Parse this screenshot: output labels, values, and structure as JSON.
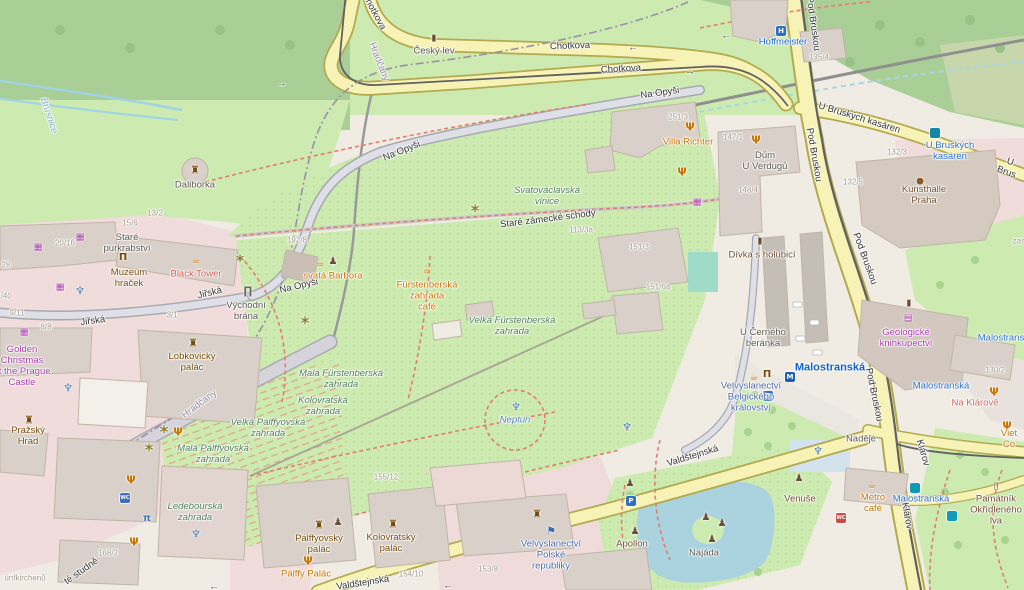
{
  "map_title": "OpenStreetMap — Prague Castle / Malostranská area",
  "colors": {
    "base": "#f0ece4",
    "forest": "#a9cf97",
    "grass": "#cdebb0",
    "scrub": "#c8d7ab",
    "attraction_pink": "#f0dcda",
    "building": "#d9d0c9",
    "road_yellow": "#f7f3b6",
    "road_gray": "#dfdfe8",
    "water": "#aad3df",
    "path_red": "#e07f70",
    "transit_blue": "#2a6fc9",
    "poi_orange": "#c77400",
    "shop_purple": "#ac39ac"
  },
  "labels": [
    {
      "n": "street-chotkova-1",
      "t": "Chotkova",
      "x": 570,
      "y": 47,
      "c": "road",
      "r": -2
    },
    {
      "n": "street-chotkova-2",
      "t": "Chotkova",
      "x": 621,
      "y": 70,
      "c": "road",
      "r": -3
    },
    {
      "n": "street-chotkova-3",
      "t": "Chotkova",
      "x": 373,
      "y": 12,
      "c": "road",
      "r": 62
    },
    {
      "n": "street-na-opysi-1",
      "t": "Na Opyši",
      "x": 660,
      "y": 94,
      "c": "road",
      "r": -8
    },
    {
      "n": "street-na-opysi-2",
      "t": "Na Opyši",
      "x": 402,
      "y": 152,
      "c": "road",
      "r": -22
    },
    {
      "n": "street-na-opysi-3",
      "t": "Na Opyši",
      "x": 299,
      "y": 287,
      "c": "road",
      "r": -13
    },
    {
      "n": "street-pod-bruskou-1",
      "t": "Pod Bruskou",
      "x": 812,
      "y": 24,
      "c": "road",
      "r": 82
    },
    {
      "n": "street-pod-bruskou-2",
      "t": "Pod Bruskou",
      "x": 813,
      "y": 155,
      "c": "road",
      "r": 80
    },
    {
      "n": "street-pod-bruskou-3",
      "t": "Pod Bruskou",
      "x": 864,
      "y": 259,
      "c": "road",
      "r": 70
    },
    {
      "n": "street-pod-bruskou-4",
      "t": "Pod Bruskou",
      "x": 873,
      "y": 395,
      "c": "road",
      "r": 78
    },
    {
      "n": "street-u-bruskych-kasaren",
      "t": "U Bruských kasáren",
      "x": 859,
      "y": 119,
      "c": "road",
      "r": 17
    },
    {
      "n": "street-u-bruskych-partial",
      "t": "U Brus",
      "x": 1008,
      "y": 168,
      "c": "road",
      "r": 20
    },
    {
      "n": "street-klarov-1",
      "t": "Klárov",
      "x": 922,
      "y": 453,
      "c": "road",
      "r": 74
    },
    {
      "n": "street-klarov-2",
      "t": "Klárov",
      "x": 906,
      "y": 516,
      "c": "road",
      "r": 80
    },
    {
      "n": "street-valdstejnska-1",
      "t": "Valdštejnská",
      "x": 693,
      "y": 457,
      "c": "road",
      "r": -17
    },
    {
      "n": "street-valdstejnska-2",
      "t": "Valdštejnská",
      "x": 363,
      "y": 584,
      "c": "road",
      "r": -9
    },
    {
      "n": "street-jirska-1",
      "t": "Jiřská",
      "x": 93,
      "y": 322,
      "c": "road",
      "r": -8
    },
    {
      "n": "street-jirska-2",
      "t": "Jiřská",
      "x": 210,
      "y": 294,
      "c": "road",
      "r": -14
    },
    {
      "n": "street-stare-zamecke-schody",
      "t": "Staré zámecké schody",
      "x": 548,
      "y": 220,
      "c": "road",
      "r": -7
    },
    {
      "n": "street-studne-partial",
      "t": "té studně",
      "x": 82,
      "y": 572,
      "c": "road",
      "r": -35
    },
    {
      "n": "stream-brusnice",
      "t": "Brusnice",
      "x": 48,
      "y": 116,
      "c": "stream",
      "r": 72
    },
    {
      "n": "boundary-hradcany-1",
      "t": "Hradčany",
      "x": 378,
      "y": 62,
      "c": "boundary",
      "r": 68
    },
    {
      "n": "boundary-hradcany-2",
      "t": "Hradčany",
      "x": 200,
      "y": 405,
      "c": "boundary",
      "r": -37
    },
    {
      "n": "poi-cesky-lev",
      "t": "Český lev",
      "x": 434,
      "y": 52,
      "c": "poi"
    },
    {
      "n": "poi-hoffmeister",
      "t": "Hoffmeister",
      "x": 783,
      "y": 43,
      "c": "hotel"
    },
    {
      "n": "poi-villa-richter",
      "t": "Villa Richter",
      "x": 688,
      "y": 143,
      "c": "food"
    },
    {
      "n": "poi-dum-u-verdugu",
      "t": "Dům\nU Verdugů",
      "x": 765,
      "y": 162,
      "c": "poi"
    },
    {
      "n": "transit-u-bruskych-kasaren",
      "t": "U Bruských\nkasáren",
      "x": 950,
      "y": 152,
      "c": "blue"
    },
    {
      "n": "poi-kunsthalle-praha",
      "t": "Kunsthalle\nPraha",
      "x": 924,
      "y": 196,
      "c": "brown2"
    },
    {
      "n": "poi-geologicke-knihkupectvi",
      "t": "Geologické\nknihkupectví",
      "x": 906,
      "y": 339,
      "c": "shop"
    },
    {
      "n": "station-malostranska",
      "t": "Malostranská",
      "x": 830,
      "y": 368,
      "c": "bluebold"
    },
    {
      "n": "transit-malostranska-1",
      "t": "Malostranská",
      "x": 941,
      "y": 387,
      "c": "blue"
    },
    {
      "n": "transit-malostranska-2",
      "t": "Malostranská",
      "x": 921,
      "y": 500,
      "c": "blue"
    },
    {
      "n": "transit-malostranska-3",
      "t": "Malostranská",
      "x": 1006,
      "y": 339,
      "c": "blue"
    },
    {
      "n": "poi-na-klarove",
      "t": "Na Klárově",
      "x": 975,
      "y": 404,
      "c": "salmon"
    },
    {
      "n": "poi-viet-co",
      "t": "Viet Co",
      "x": 1009,
      "y": 440,
      "c": "food"
    },
    {
      "n": "poi-divka-s-holubici",
      "t": "Dívka s holubicí",
      "x": 762,
      "y": 256,
      "c": "brown2"
    },
    {
      "n": "poi-u-cerneho-beranka",
      "t": "U Černého\nberánka",
      "x": 763,
      "y": 339,
      "c": "poi"
    },
    {
      "n": "area-svatovaclavska-vinice",
      "t": "Svatováclavská\nvinice",
      "x": 547,
      "y": 197,
      "c": "garden"
    },
    {
      "n": "poi-svata-barbora",
      "t": "svatá Barbora",
      "x": 333,
      "y": 277,
      "c": "food"
    },
    {
      "n": "poi-furstenberska-cafe",
      "t": "Fürstenberská\nzahrada\ncafé",
      "x": 427,
      "y": 297,
      "c": "food"
    },
    {
      "n": "area-velka-furstenberska",
      "t": "Velká Fürstenberská\nzahrada",
      "x": 512,
      "y": 327,
      "c": "garden"
    },
    {
      "n": "area-mala-furstenberska",
      "t": "Malá Fürstenberská\nzahrada",
      "x": 341,
      "y": 380,
      "c": "garden"
    },
    {
      "n": "area-kolovratska-zahrada",
      "t": "Kolovratská\nzahrada",
      "x": 323,
      "y": 407,
      "c": "garden"
    },
    {
      "n": "area-velka-palffyovska",
      "t": "Velká Pálffyovská\nzahrada",
      "x": 268,
      "y": 429,
      "c": "garden"
    },
    {
      "n": "area-mala-palffyovska",
      "t": "Malá Pálffyovská\nzahrada",
      "x": 213,
      "y": 455,
      "c": "garden"
    },
    {
      "n": "area-ledebourska-zahrada",
      "t": "Ledebourská\nzahrada",
      "x": 195,
      "y": 513,
      "c": "garden"
    },
    {
      "n": "poi-neptun",
      "t": "Neptun",
      "x": 515,
      "y": 421,
      "c": "water"
    },
    {
      "n": "poi-daliborka",
      "t": "Daliborka",
      "x": 195,
      "y": 186,
      "c": "poi"
    },
    {
      "n": "poi-stare-purkrabstvi",
      "t": "Staré\npurkrabství",
      "x": 127,
      "y": 244,
      "c": "poi"
    },
    {
      "n": "poi-black-tower",
      "t": "Black Tower",
      "x": 196,
      "y": 275,
      "c": "red"
    },
    {
      "n": "poi-muzeum-hracek",
      "t": "Muzeum\nhraček",
      "x": 129,
      "y": 279,
      "c": "brown"
    },
    {
      "n": "poi-golden-christmas",
      "t": "Golden\nChristmas\nat the Prague\nCastle",
      "x": 22,
      "y": 367,
      "c": "shop"
    },
    {
      "n": "poi-lobkovicky-palac",
      "t": "Lobkovický\npalác",
      "x": 192,
      "y": 363,
      "c": "brown"
    },
    {
      "n": "poi-vychodni-brana",
      "t": "Východní\nbrána",
      "x": 246,
      "y": 312,
      "c": "poi"
    },
    {
      "n": "poi-prazsky-hrad",
      "t": "Pražský\nHrad",
      "x": 28,
      "y": 437,
      "c": "brown"
    },
    {
      "n": "poi-palffyovsky-palac",
      "t": "Pálffyovský\npalác",
      "x": 319,
      "y": 545,
      "c": "brown"
    },
    {
      "n": "poi-kolovratsky-palac",
      "t": "Kolovratský\npalác",
      "x": 391,
      "y": 544,
      "c": "brown"
    },
    {
      "n": "poi-palffy-palac",
      "t": "Pálffy Palác",
      "x": 306,
      "y": 575,
      "c": "food"
    },
    {
      "n": "poi-velvyslanectvi-polske",
      "t": "Velvyslanectví\nPolské\nrepubliky",
      "x": 551,
      "y": 556,
      "c": "emb"
    },
    {
      "n": "poi-velvyslanectvi-belgicke",
      "t": "Velvyslanectví\nBelgického\nkrálovství",
      "x": 751,
      "y": 398,
      "c": "emb"
    },
    {
      "n": "poi-nadeje",
      "t": "Naděje",
      "x": 861,
      "y": 440,
      "c": "poi"
    },
    {
      "n": "poi-venuse",
      "t": "Venuše",
      "x": 800,
      "y": 500,
      "c": "brown2"
    },
    {
      "n": "poi-apollon",
      "t": "Apollon",
      "x": 632,
      "y": 545,
      "c": "brown2"
    },
    {
      "n": "poi-najada",
      "t": "Najáda",
      "x": 704,
      "y": 554,
      "c": "poi"
    },
    {
      "n": "poi-metro-cafe",
      "t": "Metro\ncafé",
      "x": 873,
      "y": 504,
      "c": "food"
    },
    {
      "n": "poi-pamatnik-okridleneho-lva",
      "t": "Památník\nOkřídleného\nlva",
      "x": 996,
      "y": 511,
      "c": "brown2"
    },
    {
      "n": "poi-partial-zas",
      "t": "zas",
      "x": 1019,
      "y": 241,
      "c": "hn"
    },
    {
      "n": "poi-partial-unfkirchenu",
      "t": "ünfkirchenů",
      "x": 25,
      "y": 578,
      "c": "hn"
    },
    {
      "n": "housenumber-135-4",
      "t": "135/4",
      "x": 819,
      "y": 57,
      "c": "hn"
    },
    {
      "n": "housenumber-251-3",
      "t": "251/3",
      "x": 678,
      "y": 117,
      "c": "hn"
    },
    {
      "n": "housenumber-147-1",
      "t": "147/1",
      "x": 733,
      "y": 137,
      "c": "hn"
    },
    {
      "n": "housenumber-148-4",
      "t": "148/4",
      "x": 748,
      "y": 190,
      "c": "hn"
    },
    {
      "n": "housenumber-132-3",
      "t": "132/3",
      "x": 897,
      "y": 152,
      "c": "hn"
    },
    {
      "n": "housenumber-132-5",
      "t": "132/5",
      "x": 853,
      "y": 182,
      "c": "hn"
    },
    {
      "n": "housenumber-130-2",
      "t": "130/2",
      "x": 995,
      "y": 370,
      "c": "hn"
    },
    {
      "n": "housenumber-113-3a",
      "t": "113/3a",
      "x": 581,
      "y": 230,
      "c": "hn"
    },
    {
      "n": "housenumber-151-3",
      "t": "151/3",
      "x": 639,
      "y": 247,
      "c": "hn"
    },
    {
      "n": "housenumber-151-6a",
      "t": "151/6a",
      "x": 658,
      "y": 287,
      "c": "hn"
    },
    {
      "n": "housenumber-192-8",
      "t": "192/8",
      "x": 297,
      "y": 240,
      "c": "hn"
    },
    {
      "n": "housenumber-13-2",
      "t": "13/2",
      "x": 155,
      "y": 213,
      "c": "hn"
    },
    {
      "n": "housenumber-15-6",
      "t": "15/6",
      "x": 130,
      "y": 223,
      "c": "hn"
    },
    {
      "n": "housenumber-20-16",
      "t": "20/16",
      "x": 65,
      "y": 243,
      "c": "hn"
    },
    {
      "n": "housenumber-28",
      "t": "28",
      "x": 6,
      "y": 265,
      "c": "hn"
    },
    {
      "n": "housenumber-1-40",
      "t": "1/40",
      "x": 4,
      "y": 296,
      "c": "hn"
    },
    {
      "n": "housenumber-9-11",
      "t": "9/11",
      "x": 17,
      "y": 313,
      "c": "hn"
    },
    {
      "n": "housenumber-8-8",
      "t": "8/8",
      "x": 46,
      "y": 327,
      "c": "hn"
    },
    {
      "n": "housenumber-3-1",
      "t": "3/1",
      "x": 172,
      "y": 315,
      "c": "hn"
    },
    {
      "n": "housenumber-155-12",
      "t": "155/12",
      "x": 386,
      "y": 477,
      "c": "hn"
    },
    {
      "n": "housenumber-154-10",
      "t": "154/10",
      "x": 411,
      "y": 574,
      "c": "hn"
    },
    {
      "n": "housenumber-153-8",
      "t": "153/8",
      "x": 488,
      "y": 569,
      "c": "hn"
    },
    {
      "n": "housenumber-168-2",
      "t": "168/2",
      "x": 108,
      "y": 553,
      "c": "hn"
    },
    {
      "n": "oneway-arrow-1",
      "t": "←",
      "x": 633,
      "y": 48,
      "c": "arw"
    },
    {
      "n": "oneway-arrow-2",
      "t": "→",
      "x": 690,
      "y": 72,
      "c": "arw"
    },
    {
      "n": "oneway-arrow-3",
      "t": "→",
      "x": 282,
      "y": 84,
      "c": "arw"
    },
    {
      "n": "oneway-arrow-4",
      "t": "←",
      "x": 726,
      "y": 36,
      "c": "arw"
    },
    {
      "n": "oneway-arrow-5",
      "t": "←",
      "x": 448,
      "y": 586,
      "c": "arw"
    },
    {
      "n": "oneway-arrow-6",
      "t": "←",
      "x": 214,
      "y": 587,
      "c": "arw"
    }
  ],
  "icons": [
    {
      "n": "cesky-lev-monument-icon",
      "t": "monument",
      "x": 434,
      "y": 39
    },
    {
      "n": "hoffmeister-hotel-icon",
      "t": "hotel",
      "x": 781,
      "y": 31,
      "g": "H"
    },
    {
      "n": "villa-richter-restaurant-icon",
      "t": "restaurant",
      "x": 690,
      "y": 127
    },
    {
      "n": "dum-u-verdugu-restaurant-icon",
      "t": "restaurant",
      "x": 756,
      "y": 140
    },
    {
      "n": "vinice-restaurant-icon",
      "t": "restaurant",
      "x": 682,
      "y": 172
    },
    {
      "n": "viet-co-restaurant-icon",
      "t": "restaurant",
      "x": 1007,
      "y": 426
    },
    {
      "n": "na-klarove-restaurant-icon",
      "t": "restaurant",
      "x": 994,
      "y": 392
    },
    {
      "n": "garden-restaurant-icon-1",
      "t": "restaurant",
      "x": 131,
      "y": 480
    },
    {
      "n": "garden-restaurant-icon-2",
      "t": "restaurant",
      "x": 134,
      "y": 542
    },
    {
      "n": "garden-restaurant-icon-3",
      "t": "restaurant",
      "x": 178,
      "y": 432
    },
    {
      "n": "palffy-palac-restaurant-icon",
      "t": "restaurant",
      "x": 308,
      "y": 561
    },
    {
      "n": "black-tower-cafe-icon",
      "t": "cafe",
      "x": 196,
      "y": 261
    },
    {
      "n": "svata-barbora-cafe-icon",
      "t": "cafe",
      "x": 320,
      "y": 264
    },
    {
      "n": "furstenberska-cafe-icon",
      "t": "cafe",
      "x": 427,
      "y": 271
    },
    {
      "n": "metro-cafe-icon",
      "t": "cafe",
      "x": 872,
      "y": 486
    },
    {
      "n": "plaza-cafe-icon",
      "t": "cafe",
      "x": 754,
      "y": 378
    },
    {
      "n": "muzeum-hracek-museum-icon",
      "t": "museum",
      "x": 123,
      "y": 258
    },
    {
      "n": "plaza-museum-icon",
      "t": "museum",
      "x": 767,
      "y": 375
    },
    {
      "n": "divka-monument-icon",
      "t": "monument",
      "x": 760,
      "y": 242
    },
    {
      "n": "geologicke-monument-icon",
      "t": "monument",
      "x": 909,
      "y": 304
    },
    {
      "n": "pamatnik-memorial-icon",
      "t": "memorial",
      "x": 996,
      "y": 487
    },
    {
      "n": "statue-icon-barbora",
      "t": "statue",
      "x": 333,
      "y": 262
    },
    {
      "n": "statue-icon-venuse-1",
      "t": "statue",
      "x": 799,
      "y": 479
    },
    {
      "n": "statue-icon-venuse-2",
      "t": "statue",
      "x": 630,
      "y": 484
    },
    {
      "n": "statue-icon-apollon",
      "t": "statue",
      "x": 635,
      "y": 532
    },
    {
      "n": "statue-icon-najada-1",
      "t": "statue",
      "x": 706,
      "y": 518
    },
    {
      "n": "statue-icon-najada-2",
      "t": "statue",
      "x": 722,
      "y": 524
    },
    {
      "n": "statue-icon-najada-3",
      "t": "statue",
      "x": 712,
      "y": 540
    },
    {
      "n": "statue-icon-garden",
      "t": "statue",
      "x": 338,
      "y": 523
    },
    {
      "n": "gift-shop-icon-1",
      "t": "gift",
      "x": 697,
      "y": 203
    },
    {
      "n": "gift-shop-icon-2",
      "t": "gift",
      "x": 80,
      "y": 238
    },
    {
      "n": "gift-shop-icon-3",
      "t": "gift",
      "x": 38,
      "y": 248
    },
    {
      "n": "gift-shop-icon-4",
      "t": "gift",
      "x": 60,
      "y": 288
    },
    {
      "n": "gift-shop-icon-5",
      "t": "gift",
      "x": 24,
      "y": 333
    },
    {
      "n": "book-shop-icon",
      "t": "book",
      "x": 908,
      "y": 319
    },
    {
      "n": "palette-icon",
      "t": "palette",
      "x": 920,
      "y": 182
    },
    {
      "n": "fountain-icon-neptun",
      "t": "fountain",
      "x": 516,
      "y": 407
    },
    {
      "n": "fountain-icon-garden-east",
      "t": "fountain",
      "x": 627,
      "y": 427
    },
    {
      "n": "fountain-icon-plaza",
      "t": "fountain",
      "x": 818,
      "y": 451
    },
    {
      "n": "fountain-icon-hradcany",
      "t": "fountain",
      "x": 68,
      "y": 388
    },
    {
      "n": "fountain-icon-ledebour",
      "t": "fountain",
      "x": 196,
      "y": 534
    },
    {
      "n": "fountain-icon-courtyard",
      "t": "fountain",
      "x": 80,
      "y": 291
    },
    {
      "n": "viewpoint-icon-1",
      "t": "viewpoint",
      "x": 475,
      "y": 211
    },
    {
      "n": "viewpoint-icon-2",
      "t": "viewpoint",
      "x": 305,
      "y": 323
    },
    {
      "n": "viewpoint-icon-3",
      "t": "viewpoint",
      "x": 240,
      "y": 261
    },
    {
      "n": "viewpoint-icon-4",
      "t": "viewpoint",
      "x": 164,
      "y": 432
    },
    {
      "n": "viewpoint-icon-5",
      "t": "viewpoint",
      "x": 149,
      "y": 450
    },
    {
      "n": "castle-icon-prazsky-hrad",
      "t": "castle",
      "x": 29,
      "y": 420
    },
    {
      "n": "castle-icon-lobkovicky",
      "t": "castle",
      "x": 193,
      "y": 343
    },
    {
      "n": "castle-icon-palffyovsky",
      "t": "castle",
      "x": 319,
      "y": 525
    },
    {
      "n": "castle-icon-kolovratsky",
      "t": "castle",
      "x": 393,
      "y": 524
    },
    {
      "n": "castle-icon-embassy",
      "t": "castle",
      "x": 537,
      "y": 514
    },
    {
      "n": "tower-icon-daliborka",
      "t": "castle",
      "x": 195,
      "y": 170
    },
    {
      "n": "gate-icon-vychodni-brana",
      "t": "gate",
      "x": 248,
      "y": 291
    },
    {
      "n": "flag-icon-polish-embassy",
      "t": "flag",
      "x": 551,
      "y": 531
    },
    {
      "n": "parking-icon-plaza",
      "t": "parking",
      "x": 768,
      "y": 396,
      "g": "P"
    },
    {
      "n": "parking-icon-apollon",
      "t": "parking",
      "x": 631,
      "y": 501,
      "g": "P"
    },
    {
      "n": "toilets-icon-garden",
      "t": "wc_b",
      "x": 125,
      "y": 498,
      "g": "WC"
    },
    {
      "n": "toilets-icon-klarov",
      "t": "wc_r",
      "x": 841,
      "y": 518,
      "g": "WC"
    },
    {
      "n": "bus-stop-icon",
      "t": "bus",
      "x": 935,
      "y": 133,
      "g": ""
    },
    {
      "n": "tram-stop-icon-klarov",
      "t": "tram",
      "x": 952,
      "y": 516,
      "g": ""
    },
    {
      "n": "tram-stop-icon-malostranska",
      "t": "tram",
      "x": 915,
      "y": 488,
      "g": ""
    },
    {
      "n": "metro-entrance-icon",
      "t": "metro",
      "x": 790,
      "y": 377,
      "g": "M"
    },
    {
      "n": "picnic-site-icon",
      "t": "picnic",
      "x": 147,
      "y": 519,
      "g": "π"
    }
  ]
}
